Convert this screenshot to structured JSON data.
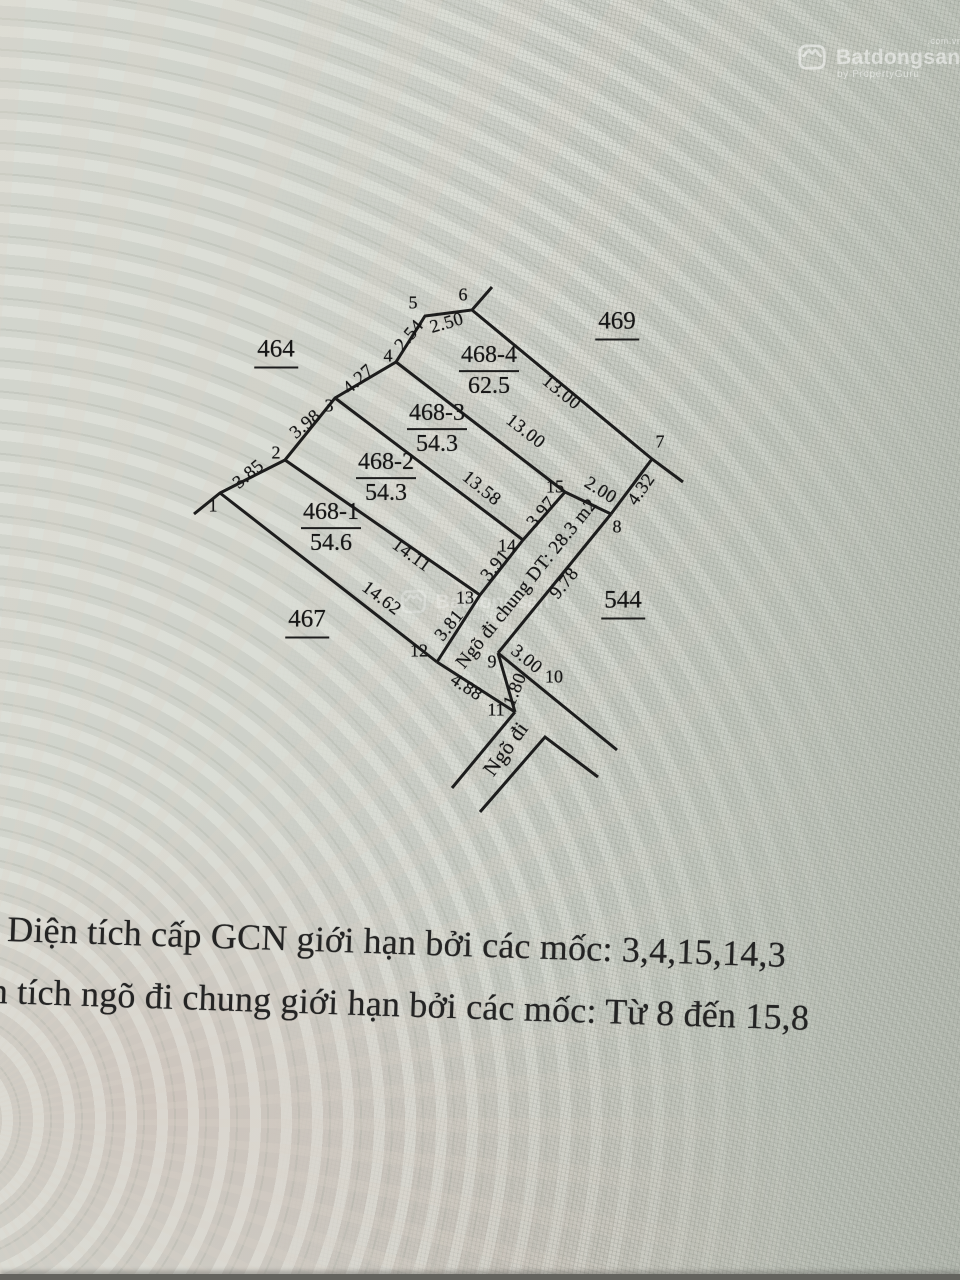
{
  "watermark": {
    "brand": "Batdongsan",
    "domain": ".com.vn",
    "byline": "by PropertyGuru"
  },
  "diagram": {
    "parcels": [
      {
        "id": "468-1",
        "area": "54.6"
      },
      {
        "id": "468-2",
        "area": "54.3"
      },
      {
        "id": "468-3",
        "area": "54.3"
      },
      {
        "id": "468-4",
        "area": "62.5"
      }
    ],
    "neighbors": [
      "464",
      "469",
      "467",
      "544"
    ],
    "points": [
      "1",
      "2",
      "3",
      "4",
      "5",
      "6",
      "7",
      "8",
      "9",
      "10",
      "11",
      "12",
      "13",
      "14",
      "15"
    ],
    "edges": {
      "e1_2": "3.85",
      "e2_3": "3.98",
      "e3_4": "4.27",
      "e4_5": "2.54",
      "e5_6": "2.50",
      "e6_7": "13.00",
      "e4_15": "13.00",
      "e3_14": "13.58",
      "e2_13": "14.11",
      "e1_12": "14.62",
      "e7_8": "4.32",
      "e15_8": "2.00",
      "e14_15": "3.97",
      "e13_14": "3.91",
      "e12_13": "3.81",
      "e8_9": "9.78",
      "e9_10": "3.00",
      "e9_11": "1.80",
      "e11_12": "4.88"
    },
    "alley_label": "Ngõ đi chung DT: 28.3 m2",
    "alley_exit_label": "Ngõ đi"
  },
  "notes": [
    "Diện tích cấp GCN giới hạn bởi các mốc: 3,4,15,14,3",
    "Diện tích ngõ đi chung giới hạn bởi các mốc: Từ 8 đến 15,8"
  ]
}
